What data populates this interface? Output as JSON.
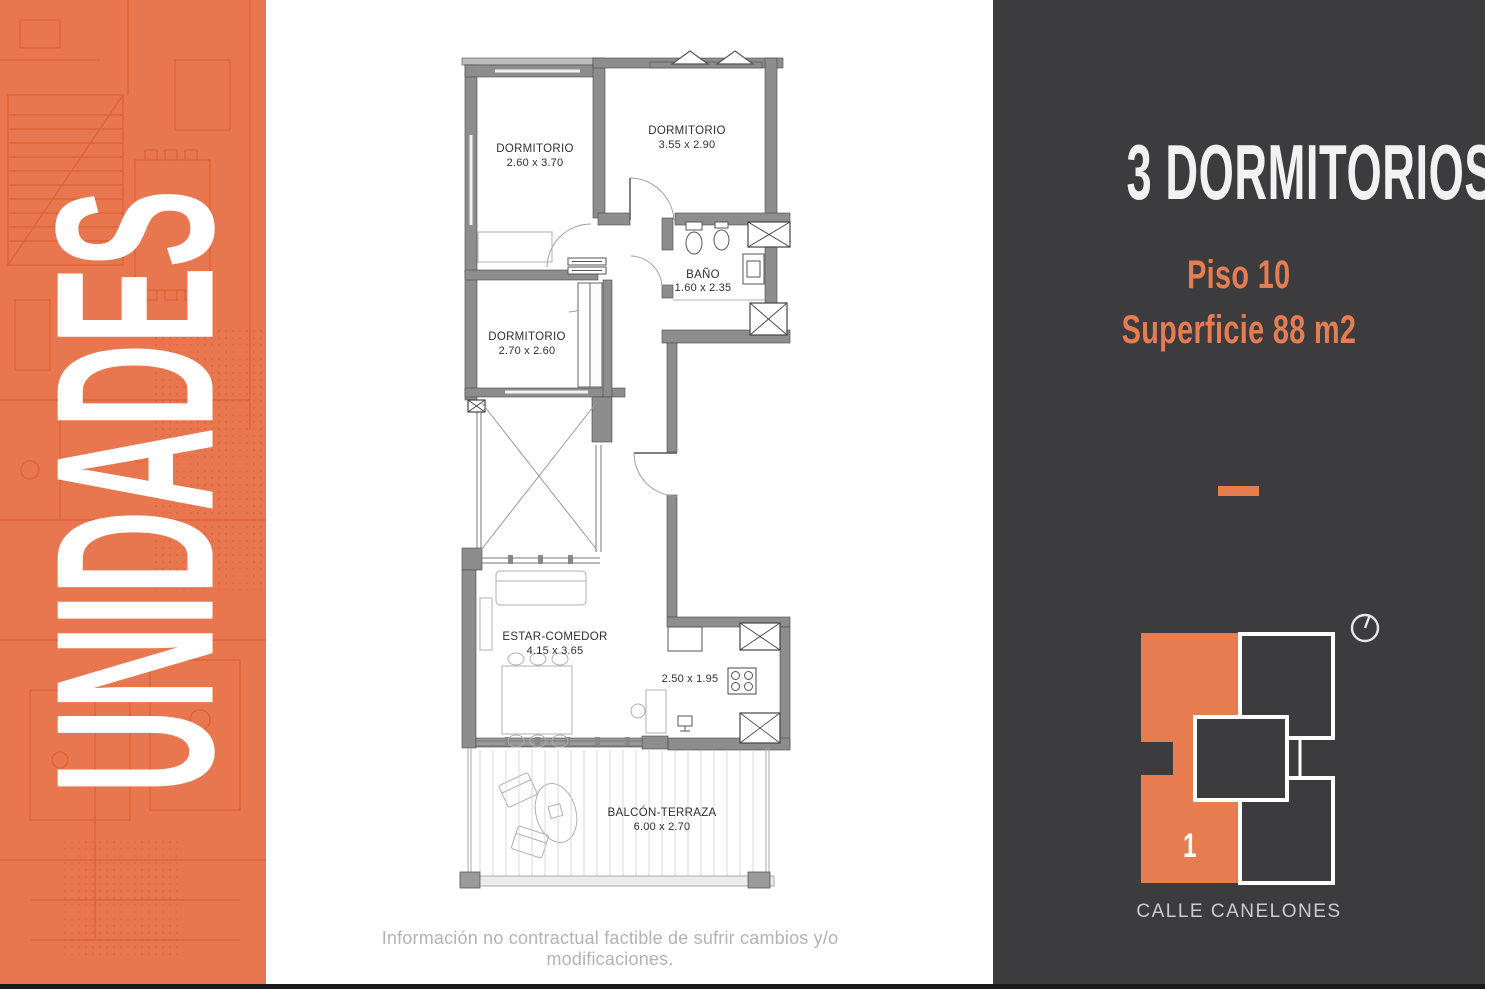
{
  "banner": {
    "title": "UNIDADES"
  },
  "plan": {
    "rooms": [
      {
        "name": "DORMITORIO",
        "dims": "2.60 x 3.70"
      },
      {
        "name": "DORMITORIO",
        "dims": "3.55 x 2.90"
      },
      {
        "name": "BAÑO",
        "dims": "1.60 x 2.35"
      },
      {
        "name": "DORMITORIO",
        "dims": "2.70 x 2.60"
      },
      {
        "name": "ESTAR-COMEDOR",
        "dims": "4.15 x 3.65"
      },
      {
        "name": "",
        "dims": "2.50 x 1.95"
      },
      {
        "name": "BALCÓN-TERRAZA",
        "dims": "6.00 x 2.70"
      }
    ],
    "disclaimer": "Información no contractual factible de sufrir cambios y/o modificaciones."
  },
  "panel": {
    "title": "3 DORMITORIOS",
    "floor_label": "Piso 10",
    "area_label": "Superficie 88 m2",
    "unit_number": "1",
    "street": "CALLE CANELONES"
  },
  "colors": {
    "banner_orange": "#E8764E",
    "banner_line_orange": "#D4511F",
    "panel_background": "#3C3C3E",
    "accent_orange": "#E87C51",
    "wall_gray": "#8D8D8D"
  }
}
